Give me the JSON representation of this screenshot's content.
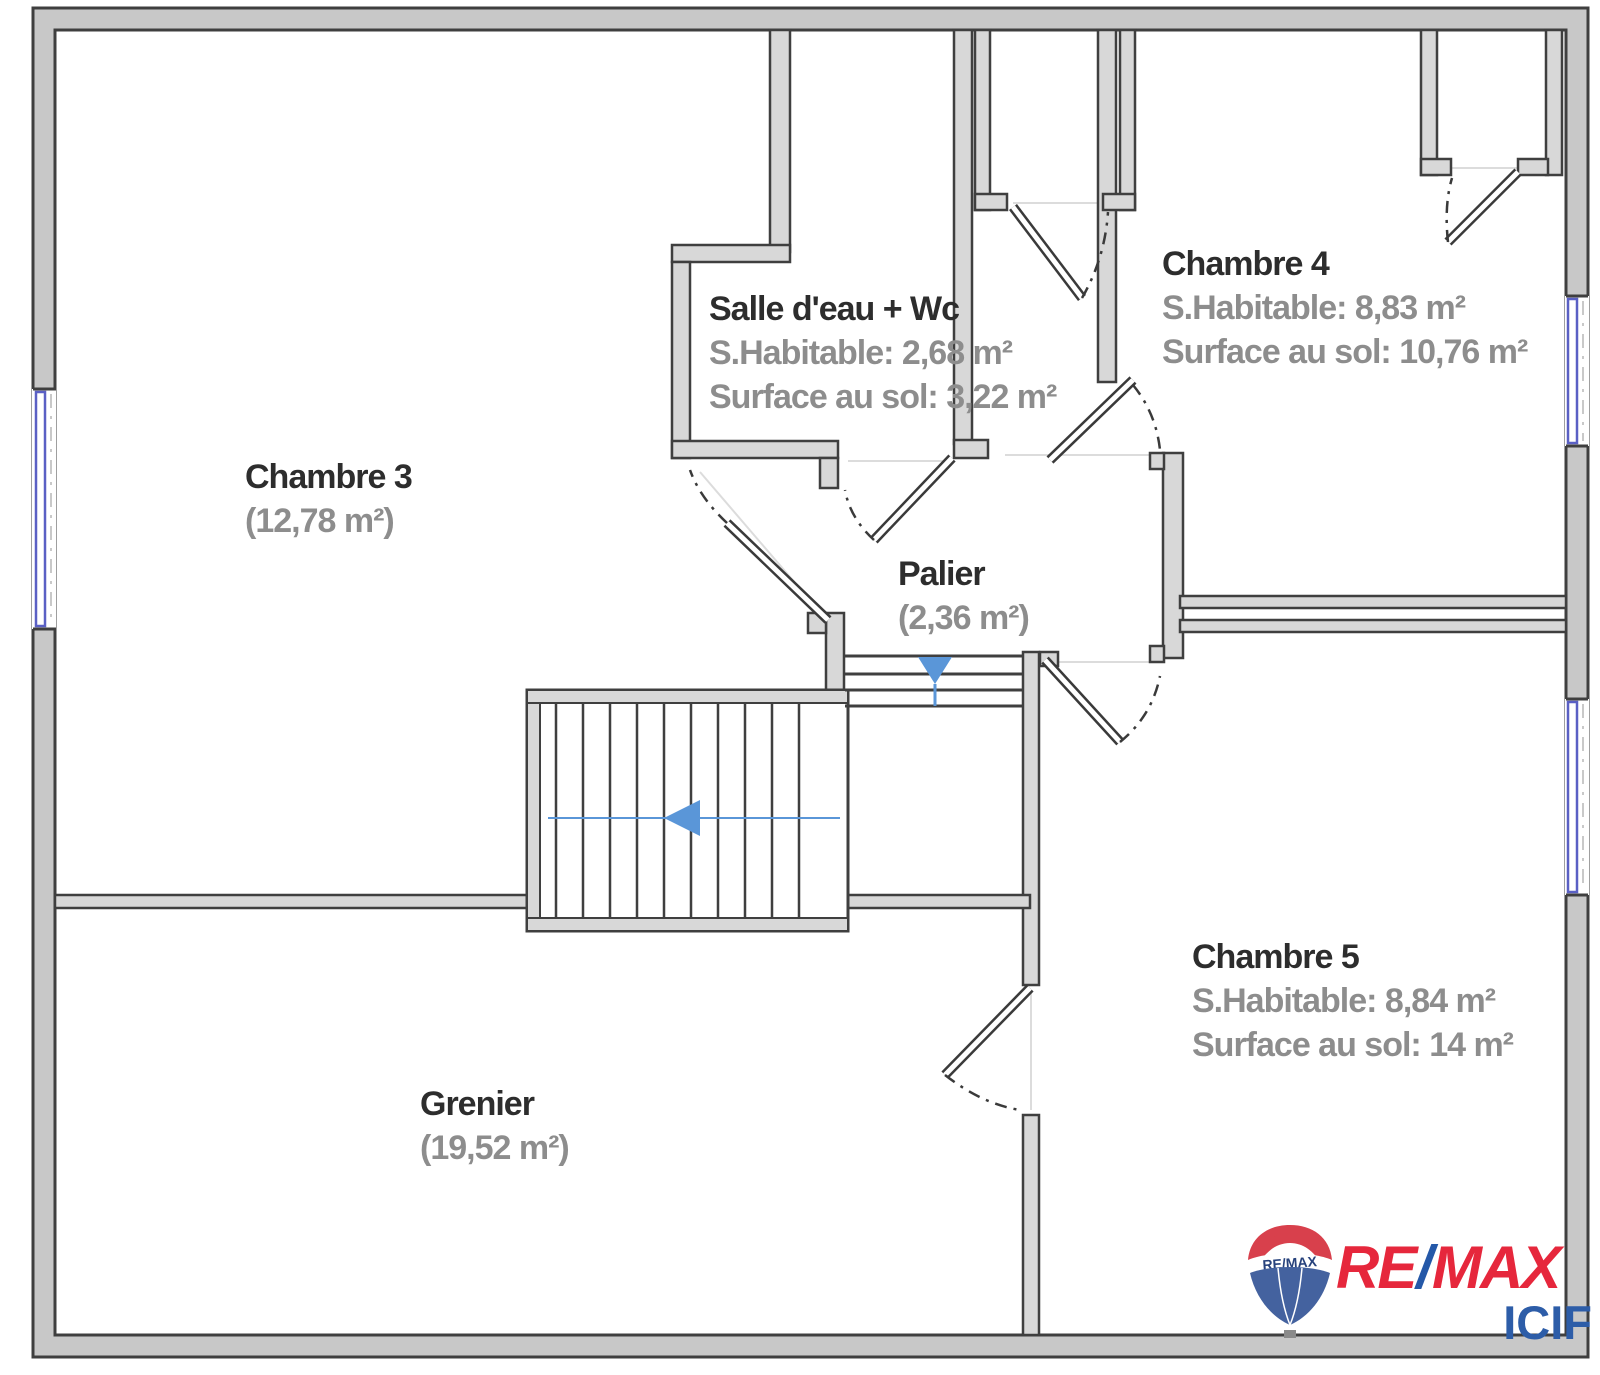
{
  "plan": {
    "rooms": [
      {
        "id": "chambre3",
        "name": "Chambre 3",
        "sub1": "(12,78 m²)"
      },
      {
        "id": "salle_eau",
        "name": "Salle d'eau + Wc",
        "sub1": "S.Habitable: 2,68 m²",
        "sub2": "Surface au sol: 3,22 m²"
      },
      {
        "id": "chambre4",
        "name": "Chambre 4",
        "sub1": "S.Habitable: 8,83 m²",
        "sub2": "Surface au sol: 10,76 m²"
      },
      {
        "id": "palier",
        "name": "Palier",
        "sub1": "(2,36 m²)"
      },
      {
        "id": "chambre5",
        "name": "Chambre 5",
        "sub1": "S.Habitable: 8,84 m²",
        "sub2": "Surface au sol: 14 m²"
      },
      {
        "id": "grenier",
        "name": "Grenier",
        "sub1": "(19,52 m²)"
      }
    ],
    "colors": {
      "wall_outline": "#3f3f3f",
      "exterior_fill": "#c8c8c8",
      "interior_fill": "#d8d8d8",
      "window_blue": "#5a60c4",
      "stair_arrow_blue": "#5a96d8",
      "room_name": "#2d2d2d",
      "room_sub": "#8d8d8d"
    },
    "logo": {
      "balloon_text": "RE/MAX",
      "brand_left": "RE",
      "brand_slash": "/",
      "brand_right": "MAX",
      "agency": "ICIF",
      "red": "#e6273c",
      "blue": "#2d5da8"
    }
  }
}
